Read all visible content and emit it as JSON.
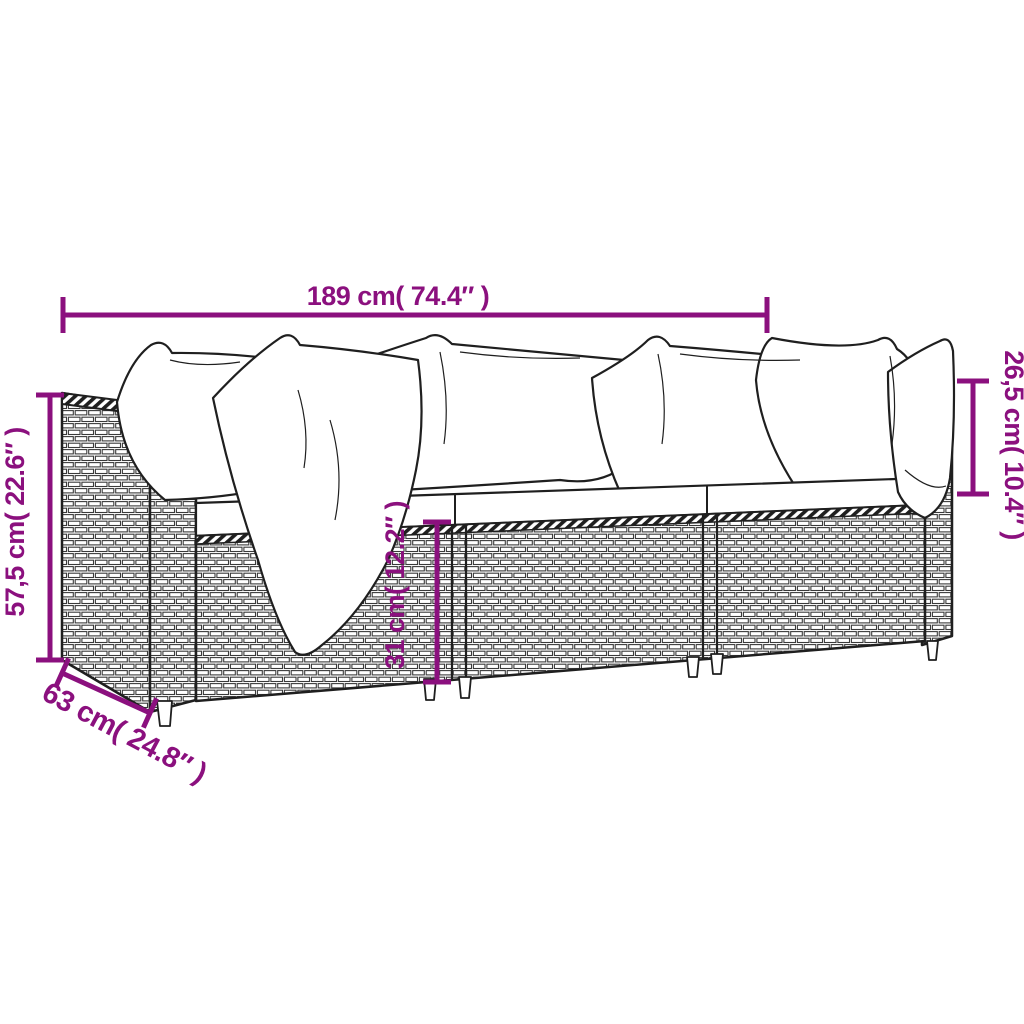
{
  "figure": {
    "subject": "rattan 3-piece garden sofa set line drawing with cushions"
  },
  "colors": {
    "background": "#ffffff",
    "line": "#1f1f1f",
    "dimension": "#8B107E"
  },
  "labels": {
    "width": "189 cm( 74.4″ )",
    "height": "57,5 cm( 22.6″ )",
    "backrest_height": "26,5 cm( 10.4″ )",
    "seat_height": "31 cm( 12.2″ )",
    "depth": "63 cm( 24.8″ )"
  }
}
